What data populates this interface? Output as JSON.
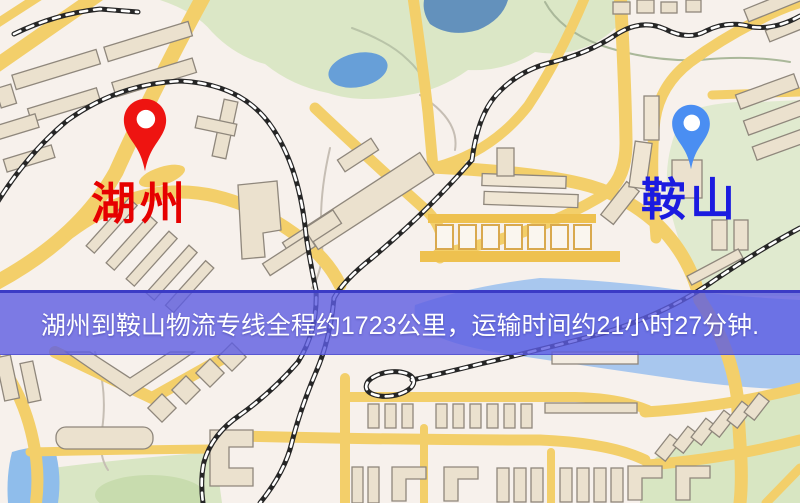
{
  "map": {
    "origin": {
      "label": "湖州",
      "label_color": "#e60000",
      "pin_color": "#ee1411"
    },
    "destination": {
      "label": "鞍山",
      "label_color": "#1b1be0",
      "pin_color": "#4a8ef2"
    },
    "banner": {
      "text": "湖州到鞍山物流专线全程约1723公里，运输时间约21小时27分钟.",
      "background": "#5c5ce2",
      "text_color": "#ffffff"
    },
    "palette": {
      "ground": "#f7f1ec",
      "road": "#f3cf6a",
      "building": "#ebe1ce",
      "park": "#dbe7c6",
      "water": "#a8c7ee",
      "railway": "#262626"
    }
  }
}
